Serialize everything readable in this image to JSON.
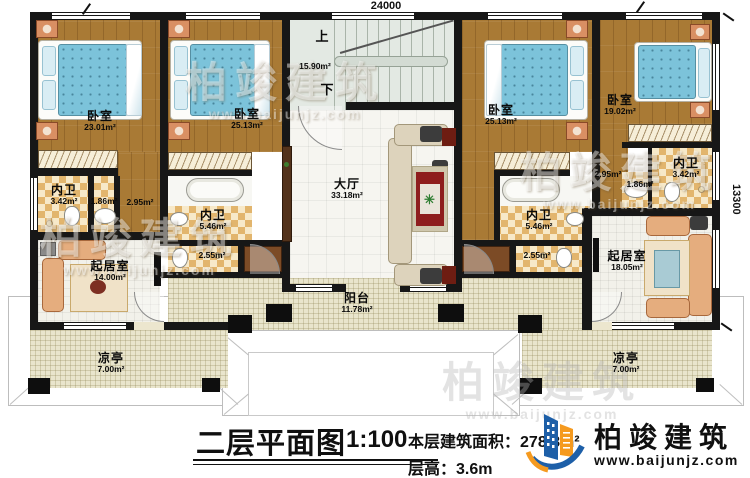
{
  "dimensions": {
    "width_top": "24000",
    "height_right": "13300"
  },
  "plan": {
    "stairs_up": "上",
    "stairs_down": "下",
    "stairs_area": "15.90m²"
  },
  "rooms": {
    "bedroom_1": {
      "name": "卧室",
      "area": "23.01m²"
    },
    "bedroom_2": {
      "name": "卧室",
      "area": "25.13m²"
    },
    "bedroom_3": {
      "name": "卧室",
      "area": "25.13m²"
    },
    "bedroom_4": {
      "name": "卧室",
      "area": "19.02m²"
    },
    "bath_left": {
      "name": "内卫",
      "area": "3.42m²"
    },
    "basin_left": {
      "area": "1.86m²"
    },
    "closet_left": {
      "area": "2.95m²"
    },
    "bath_left_2": {
      "name": "内卫",
      "area": "5.46m²"
    },
    "wc_left": {
      "area": "2.55m²"
    },
    "hall": {
      "name": "大厅",
      "area": "33.18m²"
    },
    "balcony": {
      "name": "阳台",
      "area": "11.78m²"
    },
    "bath_right_2": {
      "name": "内卫",
      "area": "5.46m²"
    },
    "wc_right": {
      "area": "2.55m²"
    },
    "bath_right": {
      "name": "内卫",
      "area": "3.42m²"
    },
    "basin_right": {
      "area": "1.86m²"
    },
    "closet_right": {
      "area": "2.95m²"
    },
    "living_left": {
      "name": "起居室",
      "area": "14.00m²"
    },
    "living_right": {
      "name": "起居室",
      "area": "18.05m²"
    },
    "pavilion_left": {
      "name": "凉亭",
      "area": "7.00m²"
    },
    "pavilion_right": {
      "name": "凉亭",
      "area": "7.00m²"
    }
  },
  "footer": {
    "title": "二层平面图",
    "scale": "1:100",
    "area_label": "本层建筑面积：",
    "area_value": "278.8m²",
    "floor_height_label": "层高：",
    "floor_height_value": "3.6m"
  },
  "brand": {
    "name": "柏竣建筑",
    "website": "www.baijunjz.com"
  },
  "watermark": {
    "name": "柏竣建筑",
    "website": "www.baijunjz.com"
  }
}
